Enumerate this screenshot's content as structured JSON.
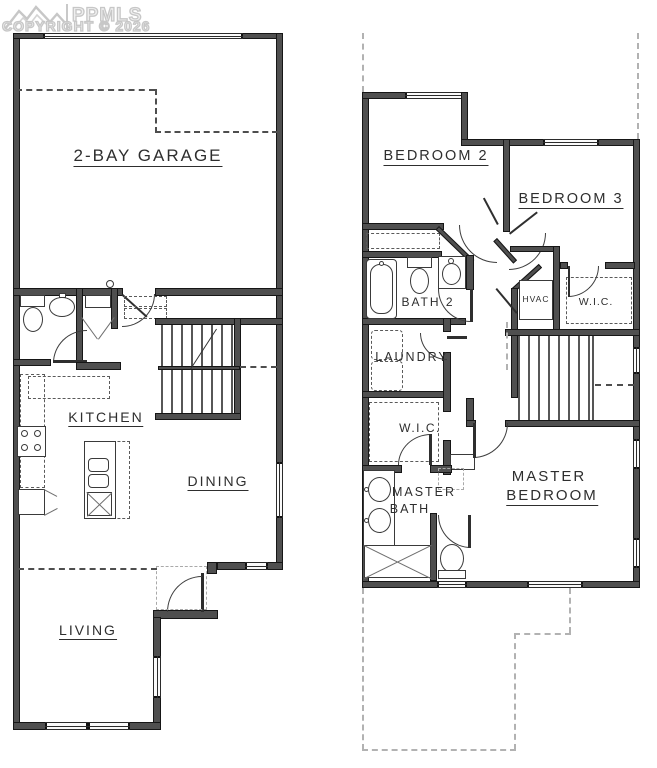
{
  "watermark": {
    "brand": "PPMLS",
    "copyright": "COPYRIGHT © 2026",
    "logo": "mountain-range-logo"
  },
  "floor1": {
    "rooms": {
      "garage": "2-BAY GARAGE",
      "kitchen": "KITCHEN",
      "dining": "DINING",
      "living": "LIVING"
    }
  },
  "floor2": {
    "rooms": {
      "bedroom2": "BEDROOM 2",
      "bedroom3": "BEDROOM 3",
      "bath2": "BATH 2",
      "laundry": "LAUNDRY",
      "hvac": "HVAC",
      "wic_hall": "W.I.C.",
      "wic_master": "W.I.C.",
      "master_bath_line1": "MASTER",
      "master_bath_line2": "BATH",
      "master_bed_line1": "MASTER",
      "master_bed_line2": "BEDROOM"
    }
  },
  "colors": {
    "background": "#ffffff",
    "wall": "#4f4f4f",
    "wall_edge": "#161616",
    "line": "#3a3a3a",
    "dash": "#555555",
    "light_dash": "#b2b2b2",
    "watermark": "#c7c7c7",
    "label": "#2e2e2e"
  },
  "fixtures": {
    "floor1": [
      "toilet",
      "pedestal-sink",
      "closet-shelf",
      "bifold-doors",
      "range",
      "island-double-sink",
      "dishwasher",
      "refrigerator",
      "doorbell"
    ],
    "floor2": [
      "bathtub",
      "toilet",
      "vanity-sink",
      "hvac-unit",
      "stacked-washer-dryer",
      "double-vanity-sinks",
      "shower",
      "toilet",
      "linen-cabinet"
    ]
  }
}
